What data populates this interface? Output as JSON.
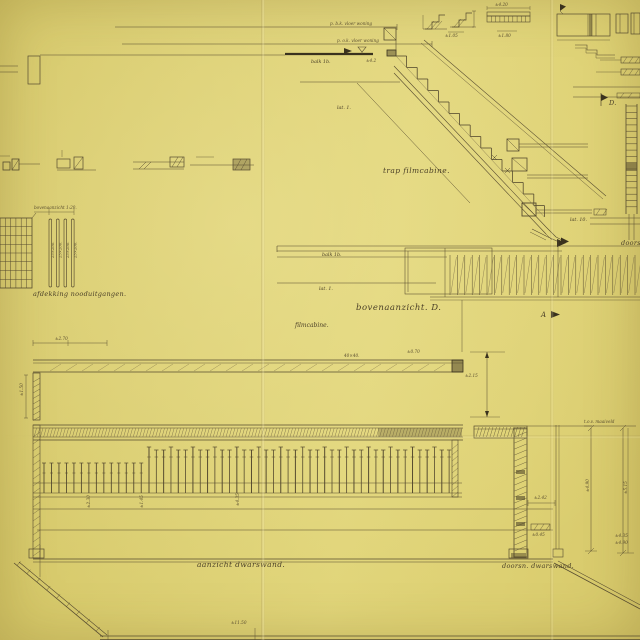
{
  "colors": {
    "paper": "#dacd71",
    "ink": "#564b2f",
    "ink_dark": "#3a321e",
    "ink_light": "#7d7048"
  },
  "titles": {
    "trap_filmcabine": "trap filmcabine.",
    "bovenaanzicht_d": "bovenaanzicht. D.",
    "filmcabine": "filmcabine.",
    "afdekking_nooduitgangen": "afdekking nooduitgangen.",
    "afdekking_scale": "bovenaanzicht 1:20.",
    "aanzicht_dwarswand": "aanzicht dwarswand.",
    "doorsn_dwarswand": "doorsn. dwarswand.",
    "doorsn_right_edge": "doorsn."
  },
  "section_markers": {
    "a": "A",
    "d": "D."
  },
  "annotations": {
    "peil_boven": "p. b.k. vloer woning",
    "peil_onder": "p. o.k. vloer woning",
    "balk_section": "balk 1b.",
    "lat_section": "lat. 1.",
    "balk_plan": "balk 1b.",
    "lat_plan": "lat. 1.",
    "lat_10": "lat. 10.",
    "maaiveld": "t.o.v. maaiveld",
    "slat_size": "25×200."
  },
  "dimensions": {
    "d42": "±4.2",
    "d270": "±2.70",
    "d4040": "40×40.",
    "d070": "±0.70",
    "d215": "±2.15",
    "d150": "±1.50",
    "d230": "±2.30",
    "d145": "±1.45",
    "d435": "±4.35",
    "d1150": "±11.50",
    "d242": "±2.42",
    "d045": "±0.45",
    "d490": "±4.90",
    "d515": "±5.15",
    "d435r": "±4.35",
    "d490r": "±4.90",
    "d105": "±1.05",
    "d420": "±4.20",
    "d180": "±1.80"
  }
}
